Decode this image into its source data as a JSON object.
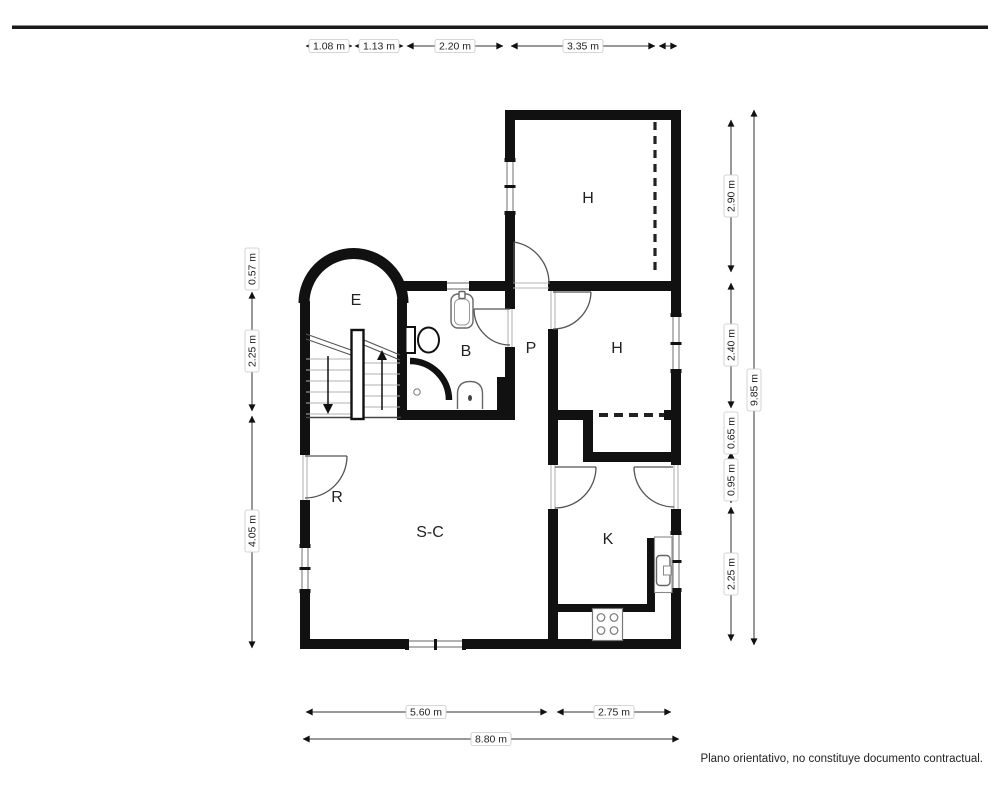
{
  "rooms": {
    "h_top": "H",
    "e": "E",
    "b": "B",
    "p": "P",
    "h_mid": "H",
    "r": "R",
    "sc": "S-C",
    "k": "K"
  },
  "dims": {
    "top1": "1.08 m",
    "top2": "1.13 m",
    "top3": "2.20 m",
    "top4": "3.35 m",
    "left1": "0.57 m",
    "left2": "2.25 m",
    "left3": "4.05 m",
    "right1": "2.90 m",
    "right2": "2.40 m",
    "right3": "0.65 m",
    "right4": "0.95 m",
    "right5": "2.25 m",
    "right_total": "9.85 m",
    "bottom1": "5.60 m",
    "bottom2": "2.75 m",
    "bottom_total": "8.80 m"
  },
  "disclaimer": "Plano orientativo, no constituye documento contractual.",
  "colors": {
    "wall": "#111111",
    "dimension": "#333333",
    "background": "#ffffff"
  }
}
